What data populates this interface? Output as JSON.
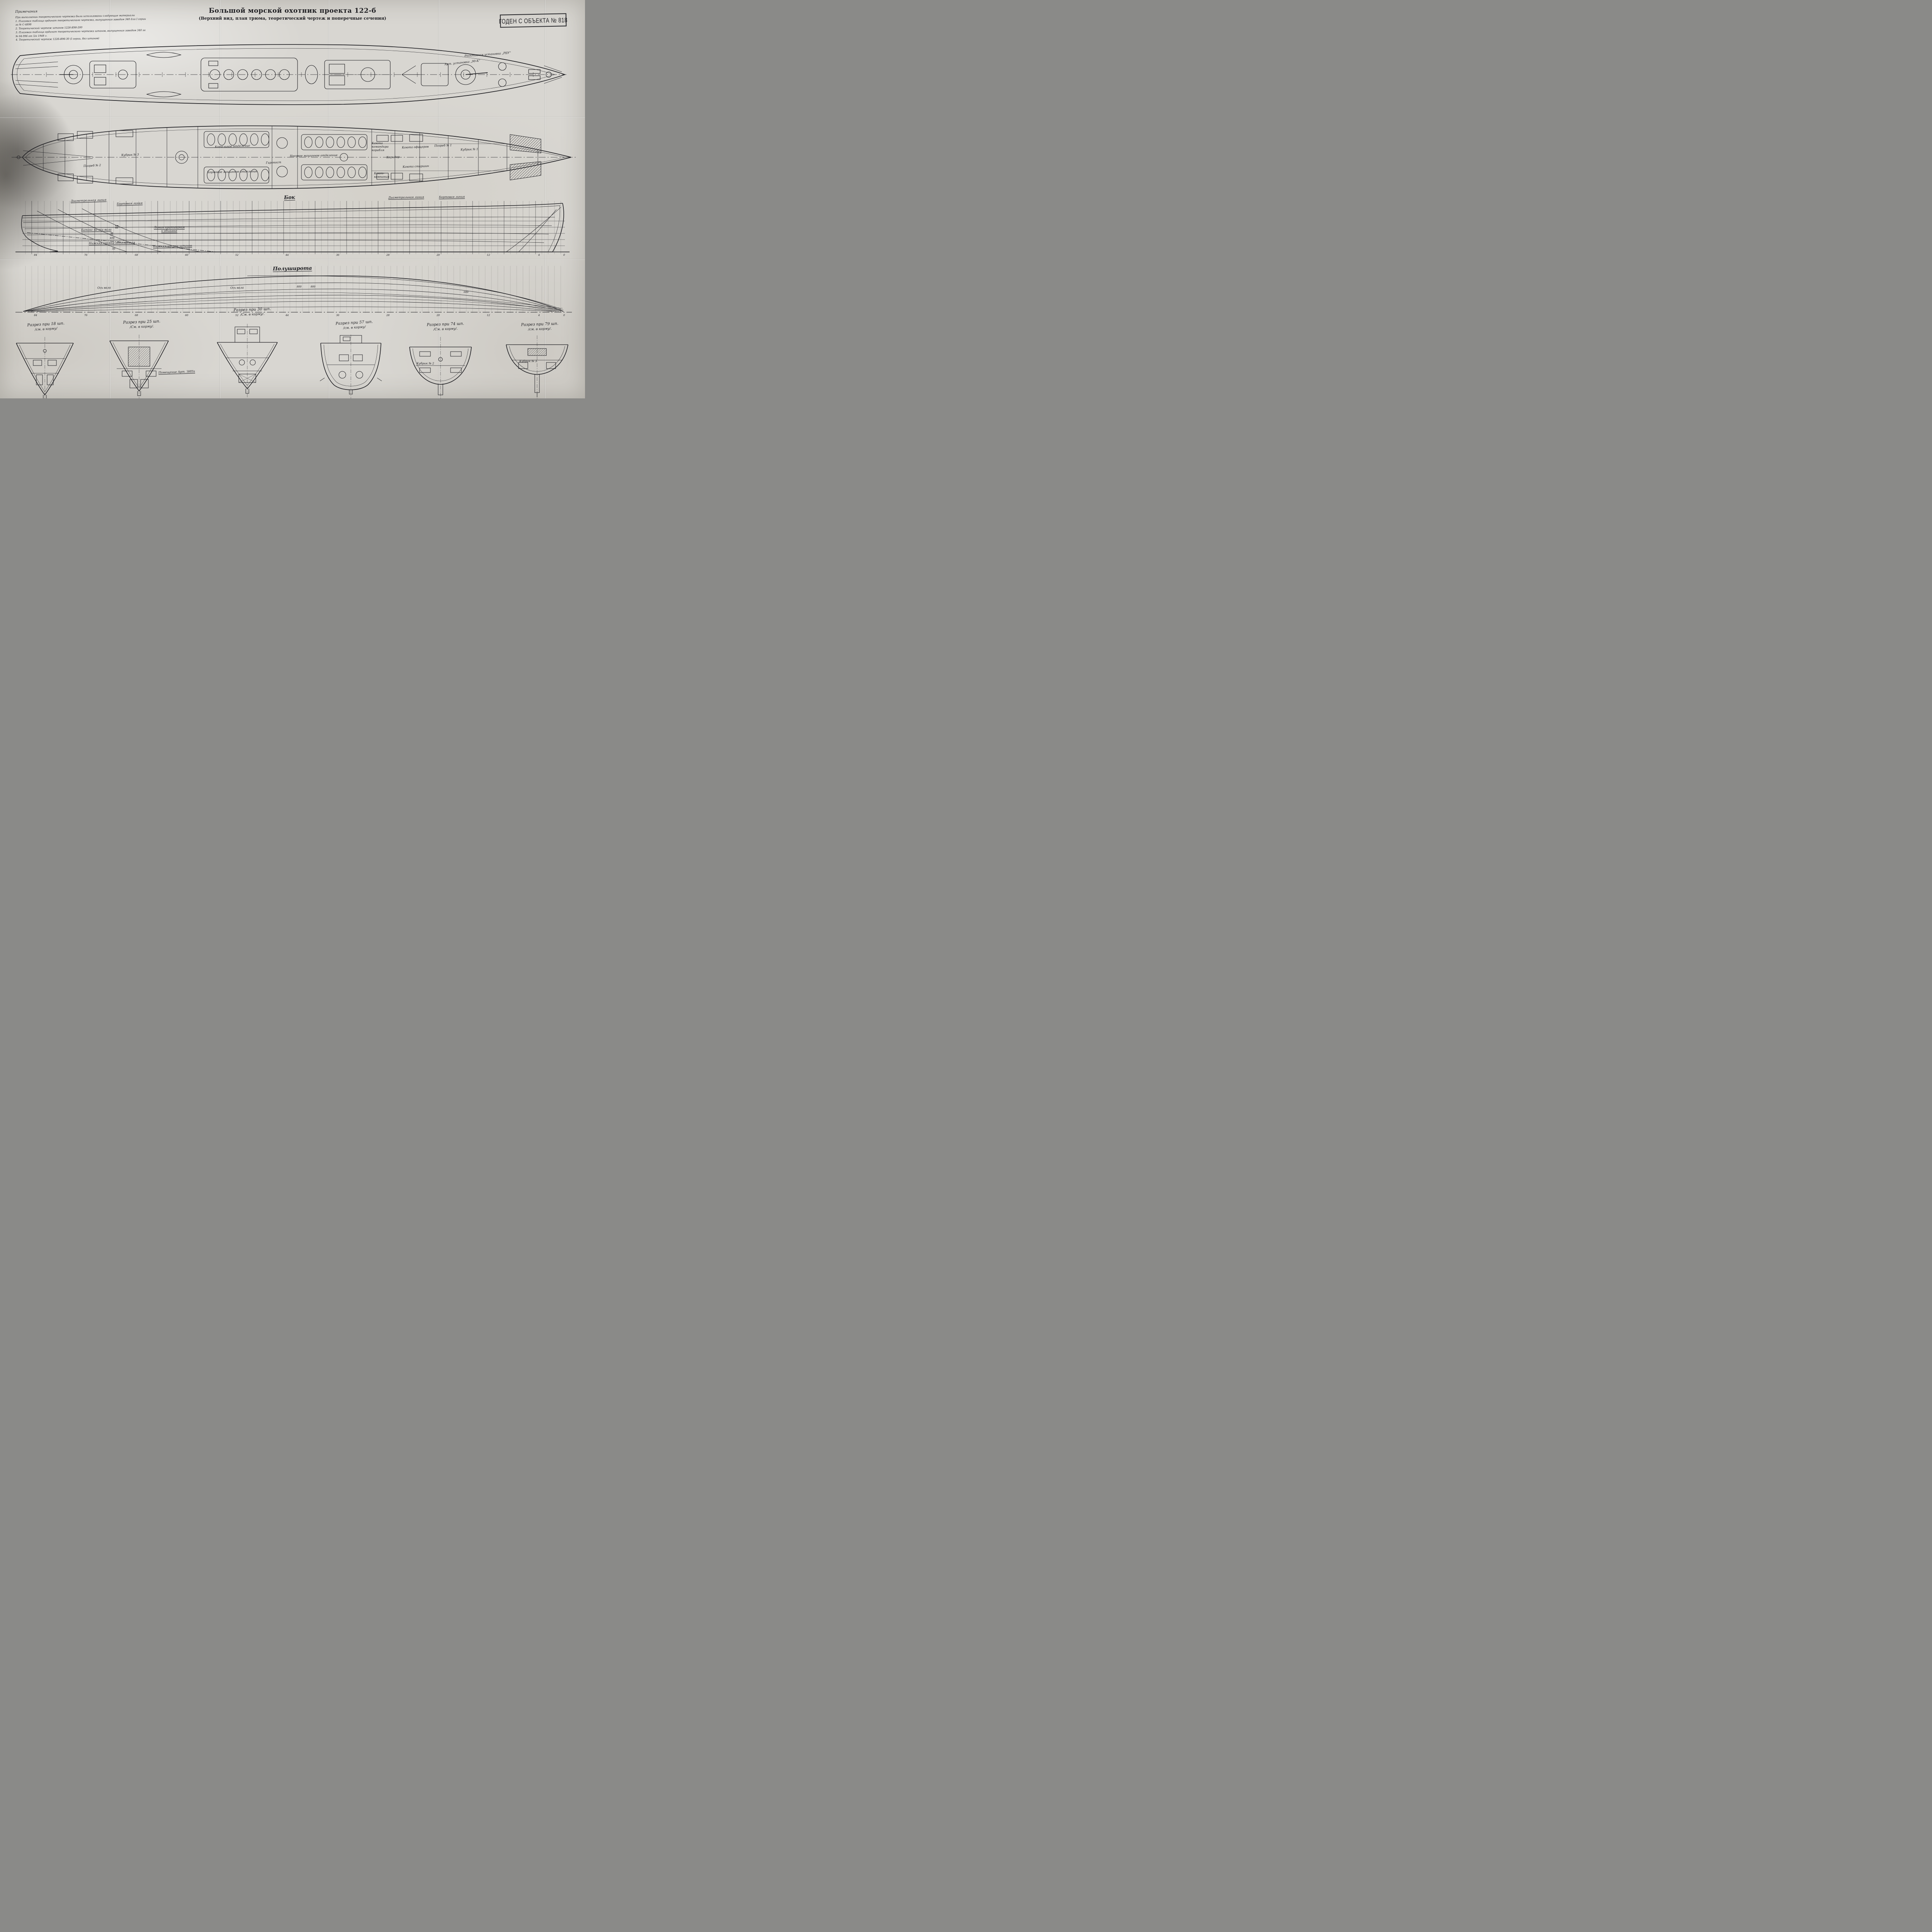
{
  "title": {
    "main": "Большой морской охотник проекта 122-б",
    "subtitle": "(Верхний вид, план трюма, теоретический чертеж и поперечные сечения)"
  },
  "stamp": "ГОДЕН С ОБЪЕКТА № 818",
  "notes": {
    "heading": "Примечания",
    "intro": "При выполнении теоретического чертежа были использованы следующие материалы",
    "items": [
      "1. Плазовая таблица ординат теоретического чертежа, выпущенная заводом 340 для I серии за № С-4898",
      "2. Теоретический чертеж штанов 122б-Я98-200",
      "3. Плазовая таблица ординат теоретического чертежа штанов, выпущенная заводом 340 за № 04-996 от 5/а 1948 г.",
      "4. Теоретический чертеж 122б-Я96-30 (I серии, без штанов)"
    ]
  },
  "deck_plan": {
    "labels": {
      "rbu": "Реактивная установка „РБУ“",
      "art": "Арт. установка „90-К“"
    }
  },
  "hold_plan": {
    "labels": {
      "boiler_room": "Котельное отделение",
      "aft_engine_room": "Кормовое машинное отделение",
      "fwd_engine_room": "Носовое машинное отделение",
      "gyro_post": "Гиропост",
      "kubrick1": "Кубрик № 1",
      "kubrick3": "Кубрик № 3",
      "magazine1": "Погреб № 1",
      "magazine2": "Погреб № 2",
      "officers_cabin": "Каюта офицеров",
      "co_cabin": "Каюта командира корабля",
      "corridor": "Коридор",
      "petty_officers_cabin": "Каюта старшин",
      "wardroom": "Кают-компания"
    }
  },
  "sheer_plan": {
    "view_label": "Бок",
    "labels": {
      "centerline_left": "Диаметральная линия",
      "side_line_left": "Бортовая линия",
      "centerline_right": "Диаметральная линия",
      "side_line_right": "Бортовая линия",
      "shaft_buttock": "Батокс по оси вала",
      "plating_join": "Линия притыкания к обшивке",
      "fairing_lower_edge": "Нижняя кромка обтекателя",
      "shtany_lower_edge": "Нижняя кромка штанов",
      "buttock_III": "Ш",
      "buttock_II": "П",
      "dim_400": "400",
      "dim_50": "50"
    },
    "frame_numbers": [
      84,
      76,
      68,
      60,
      52,
      44,
      36,
      28,
      20,
      12,
      4,
      0
    ]
  },
  "half_breadth": {
    "view_label": "Полуширота",
    "labels": {
      "shaft_axis_left": "Ось вала",
      "shaft_axis_mid": "Ось вала",
      "dim_800a": "800",
      "dim_800b": "800",
      "dim_600": "600"
    }
  },
  "sections": [
    {
      "title": "Разрез при 18 шп.",
      "subtitle": "/см. в корму/",
      "interior_label": ""
    },
    {
      "title": "Разрез при 25 шп.",
      "subtitle": "/См. в корму/.",
      "interior_label": ""
    },
    {
      "title": "Разрез при 30 шп.",
      "subtitle": "/См. в корму/.",
      "interior_label": ""
    },
    {
      "title": "Разрез при 57 шп.",
      "subtitle": "/см. в корму/",
      "interior_label": ""
    },
    {
      "title": "Разрез при 74 шп.",
      "subtitle": "/См. в корму/.",
      "interior_label": "Кубрик № 2"
    },
    {
      "title": "Разрез при 79 шп.",
      "subtitle": "/см. в корму/.",
      "interior_label": "Кубрик № 3"
    }
  ],
  "section_notes": {
    "art_zip": "Помещение Арт. ЗИПа"
  }
}
